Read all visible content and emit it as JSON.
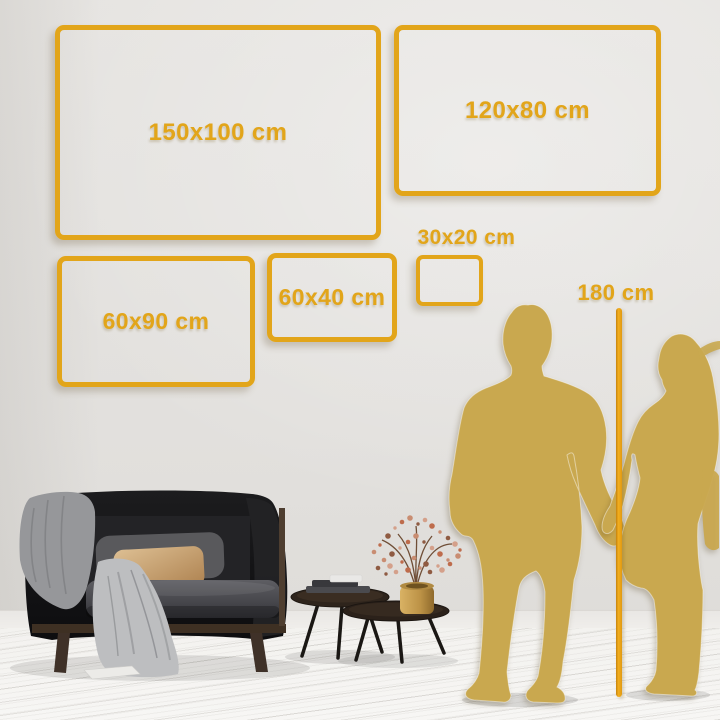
{
  "size_labels": [
    {
      "id": "150x100",
      "label": "150x100 cm"
    },
    {
      "id": "120x80",
      "label": "120x80 cm"
    },
    {
      "id": "60x90",
      "label": "60x90 cm"
    },
    {
      "id": "60x40",
      "label": "60x40 cm"
    },
    {
      "id": "30x20",
      "label": "30x20 cm"
    }
  ],
  "height_marker": {
    "label": "180 cm"
  },
  "colors": {
    "accent_gold": "#E2A51A",
    "silhouette_gold": "#C9A84F",
    "wall": "#E3E1DE",
    "floor": "#F5F4F2"
  }
}
